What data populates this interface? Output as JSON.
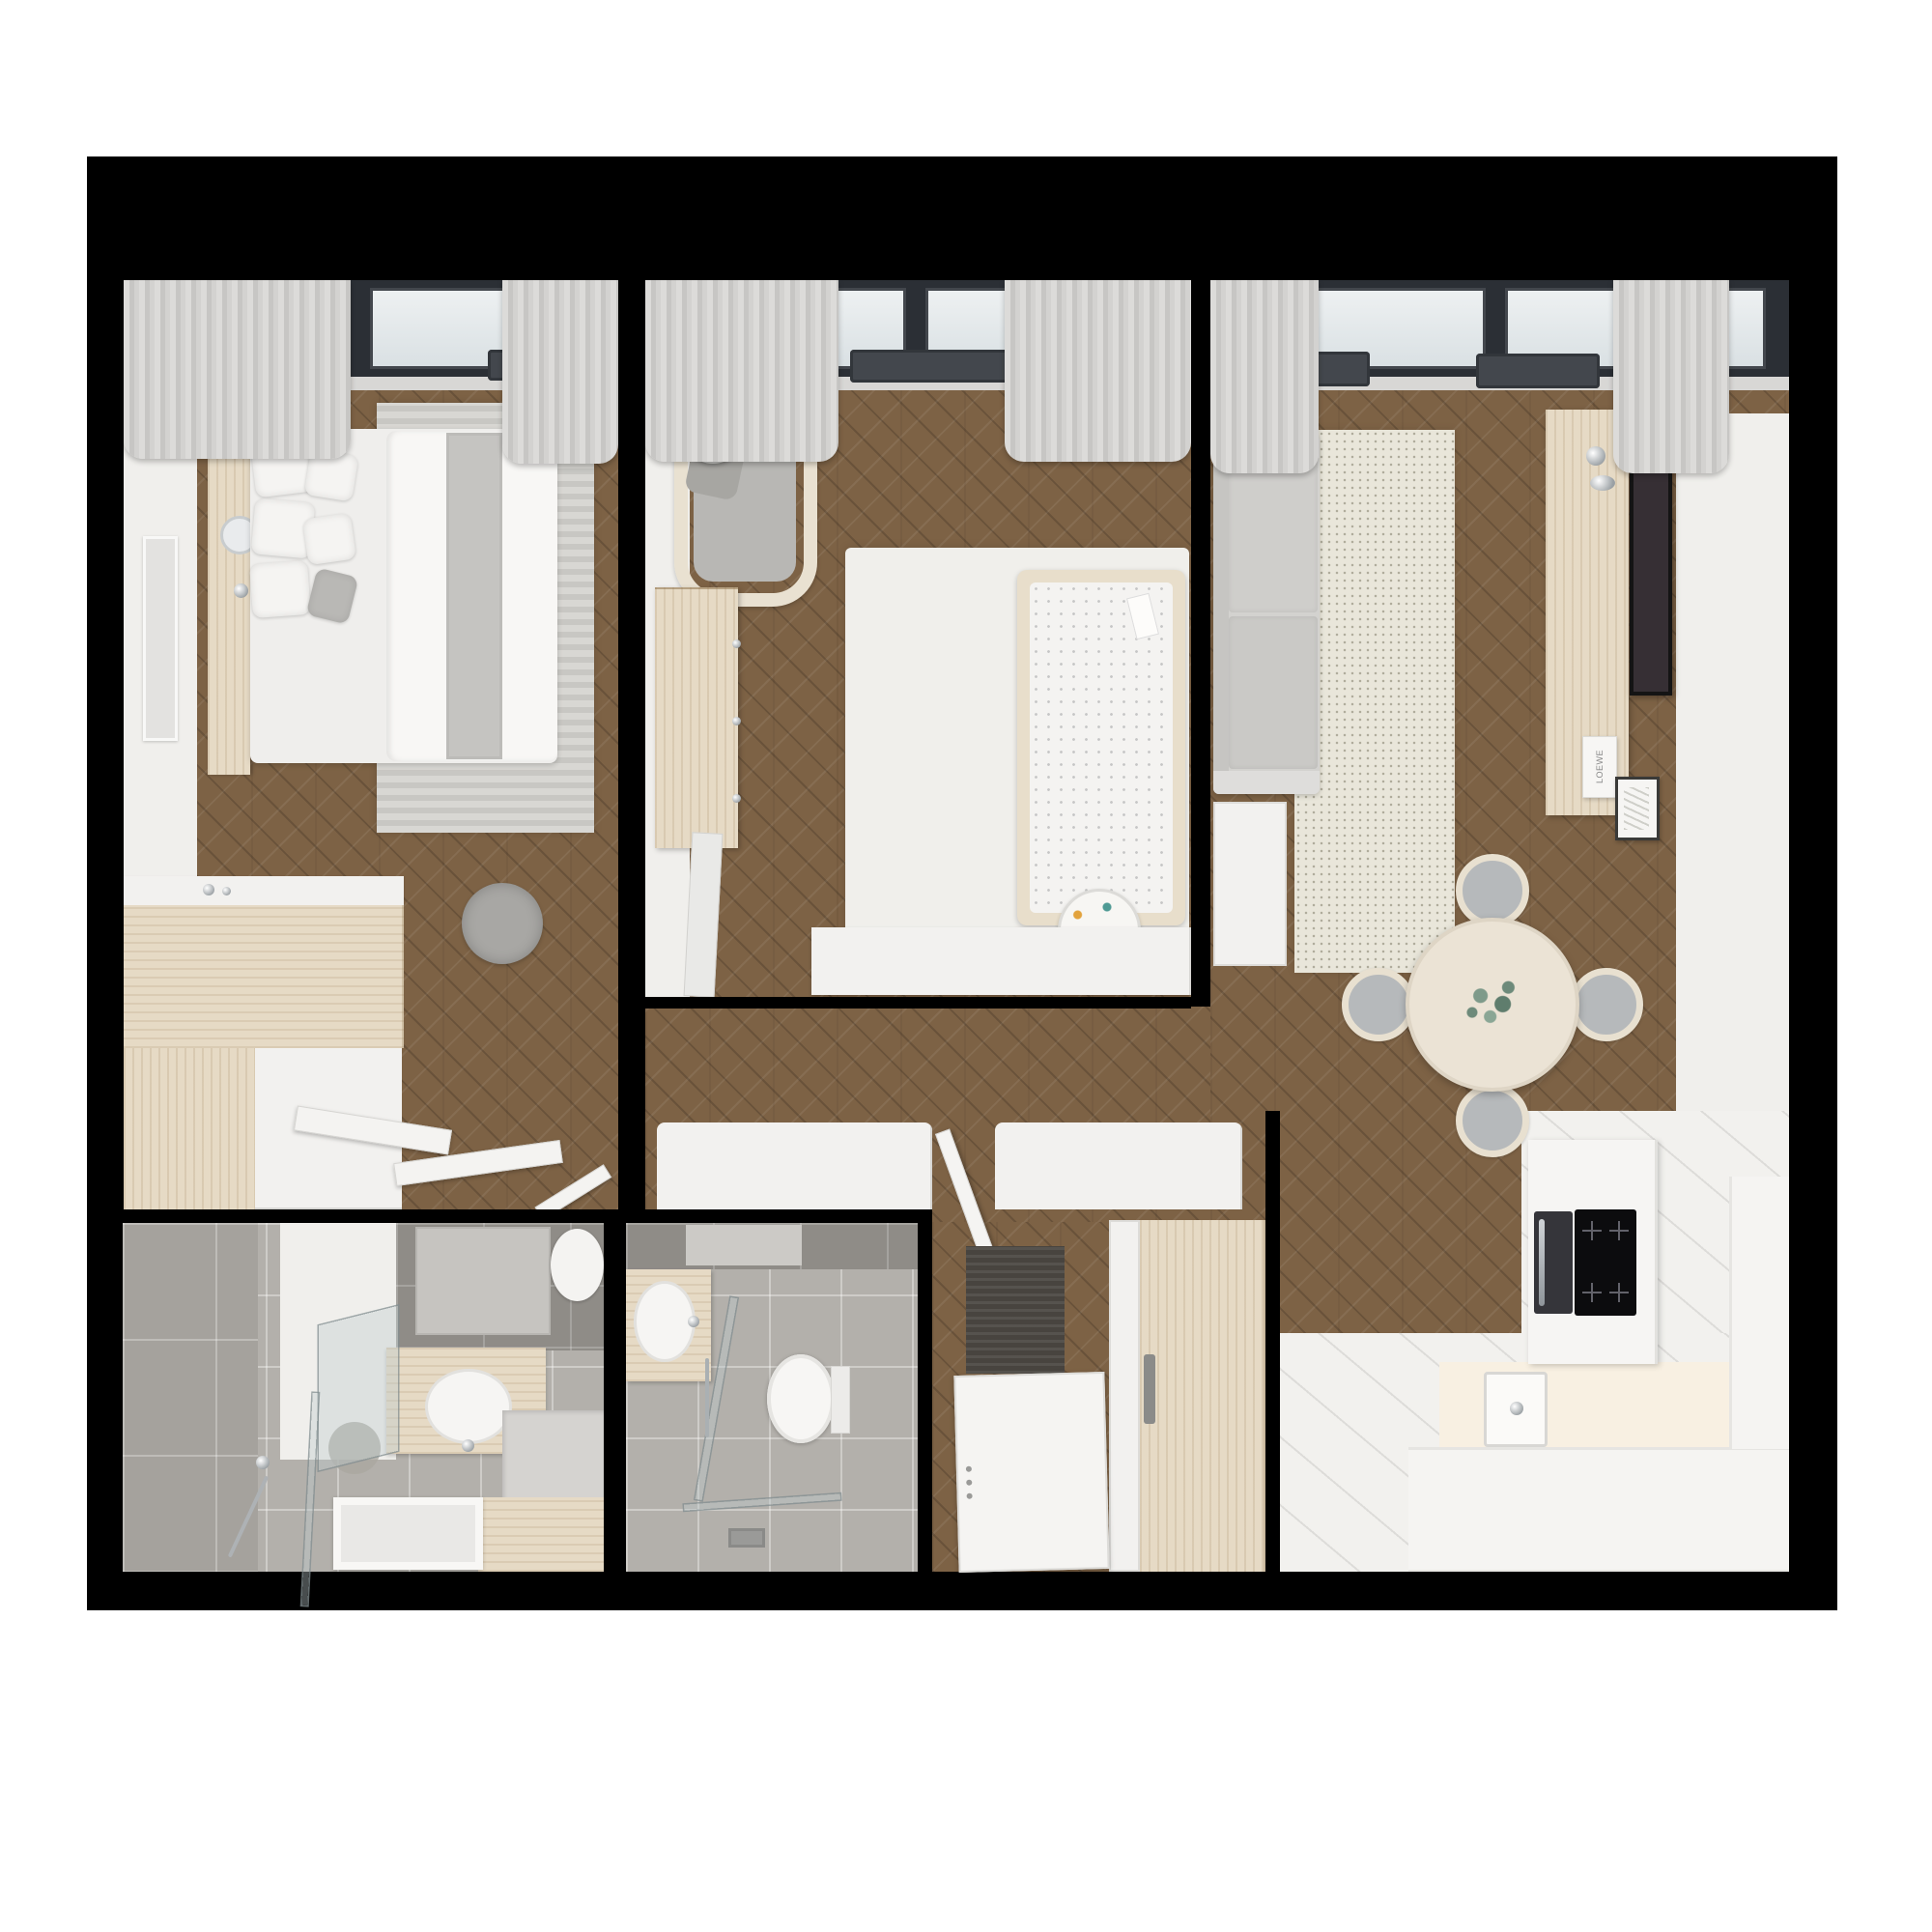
{
  "plan": {
    "title": "apartment-3d-floor-plan",
    "labels": {
      "decor_box": "Surf Shacks",
      "media_box": "LOEWE"
    },
    "rooms": [
      {
        "name": "Bedroom",
        "floor": "chevron wood",
        "furniture": [
          "double bed",
          "headboard",
          "floating nightstand",
          "decor box",
          "wall mirror lamp",
          "wall art",
          "striped rug",
          "vanity desk",
          "wardrobe",
          "drawer unit",
          "pouf",
          "open wardrobe doors",
          "radiator",
          "curtains",
          "window"
        ]
      },
      {
        "name": "Nursery",
        "floor": "chevron wood",
        "furniture": [
          "armchair",
          "floor lamp",
          "dresser",
          "crib",
          "white rug",
          "toy drum",
          "sideboard",
          "leaning mirror",
          "radiator",
          "curtains",
          "window"
        ]
      },
      {
        "name": "Living room",
        "floor": "chevron wood",
        "furniture": [
          "sofa",
          "side table",
          "speckled rug",
          "tv console",
          "wall tv",
          "decor frame",
          "media box",
          "round dining table",
          "dining chairs",
          "radiators",
          "curtains",
          "window"
        ]
      },
      {
        "name": "Kitchen",
        "floor": "white tile",
        "furniture": [
          "oven",
          "induction cooktop",
          "sink",
          "counter L",
          "counter right",
          "tall cabinet"
        ]
      },
      {
        "name": "Bathroom 1",
        "floor": "gray tile",
        "furniture": [
          "walk-in shower",
          "glass screen",
          "shower head",
          "hand shower",
          "vanity sink",
          "mirror",
          "soaking tray",
          "counter",
          "toilet"
        ]
      },
      {
        "name": "Bathroom 2",
        "floor": "gray tile",
        "furniture": [
          "vanity sink",
          "mirror",
          "glass screen",
          "toilet",
          "floor drain",
          "bath mat"
        ]
      },
      {
        "name": "Hallway",
        "floor": "chevron wood",
        "furniture": [
          "console cabinet",
          "interior door",
          "doormat",
          "entry wardrobe",
          "entry door"
        ]
      }
    ],
    "colors": {
      "background": "#ffffff",
      "walls": "#000000",
      "wood_floor": "#7d6245",
      "light_wood": "#e6dac5",
      "white_furniture": "#f2f1ef",
      "gray_tile": "#b3b0ab",
      "living_rug": "#e9e6da",
      "window_frame": "#2b2f35",
      "radiator": "#43474d",
      "tv_screen": "#362f34",
      "cooktop": "#0c0c0e",
      "doormat": "#48443f"
    }
  }
}
